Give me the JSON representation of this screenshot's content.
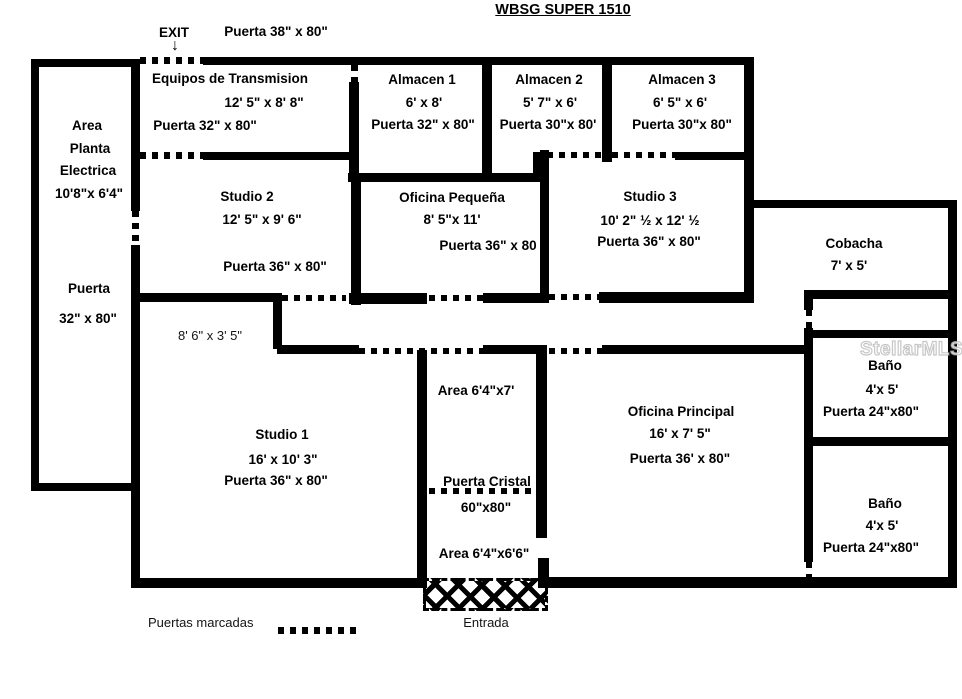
{
  "title": "WBSG SUPER 1510",
  "header": {
    "exit": "EXIT",
    "arrow": "↓",
    "door": "Puerta 38\" x 80\""
  },
  "rooms": {
    "planta": {
      "line1": "Area",
      "line2": "Planta",
      "line3": "Electrica",
      "size": "10'8\"x 6'4\"",
      "door1": "Puerta",
      "door2": "32\" x 80\""
    },
    "equipos": {
      "name": "Equipos de Transmision",
      "size": "12' 5\" x 8' 8\"",
      "door": "Puerta 32\" x 80\""
    },
    "almacen1": {
      "name": "Almacen 1",
      "size": "6' x 8'",
      "door": "Puerta 32\" x 80\""
    },
    "almacen2": {
      "name": "Almacen 2",
      "size": "5' 7\" x 6'",
      "door": "Puerta 30\"x 80'"
    },
    "almacen3": {
      "name": "Almacen 3",
      "size": "6' 5\" x 6'",
      "door": "Puerta 30\"x 80\""
    },
    "studio2": {
      "name": "Studio 2",
      "size": "12' 5\" x 9' 6\"",
      "door": "Puerta 36\" x 80\""
    },
    "oficina_pequena": {
      "name": "Oficina Pequeña",
      "size": "8' 5\"x 11'",
      "door": "Puerta 36\" x 80"
    },
    "studio3": {
      "name": "Studio 3",
      "size": "10' 2\" ½ x 12' ½",
      "door": "Puerta 36\" x 80\""
    },
    "cobacha": {
      "name": "Cobacha",
      "size": "7' x 5'"
    },
    "alcove": {
      "size": "8' 6\" x 3' 5\""
    },
    "studio1": {
      "name": "Studio 1",
      "size": "16' x 10' 3\"",
      "door": "Puerta 36\" x 80\""
    },
    "vestibulo": {
      "area_top": "Area 6'4\"x7'",
      "glass_door": "Puerta Cristal",
      "glass_size": "60\"x80\"",
      "area_bottom": "Area 6'4\"x6'6\""
    },
    "oficina_principal": {
      "name": "Oficina Principal",
      "size": "16' x 7' 5\"",
      "door": "Puerta 36' x 80\""
    },
    "bano1": {
      "name": "Baño",
      "size": "4'x 5'",
      "door": "Puerta 24\"x80\""
    },
    "bano2": {
      "name": "Baño",
      "size": "4'x 5'",
      "door": "Puerta 24\"x80\""
    }
  },
  "legend": {
    "doors_label": "Puertas marcadas",
    "entry_label": "Entrada"
  },
  "watermark": "StellarMLS"
}
